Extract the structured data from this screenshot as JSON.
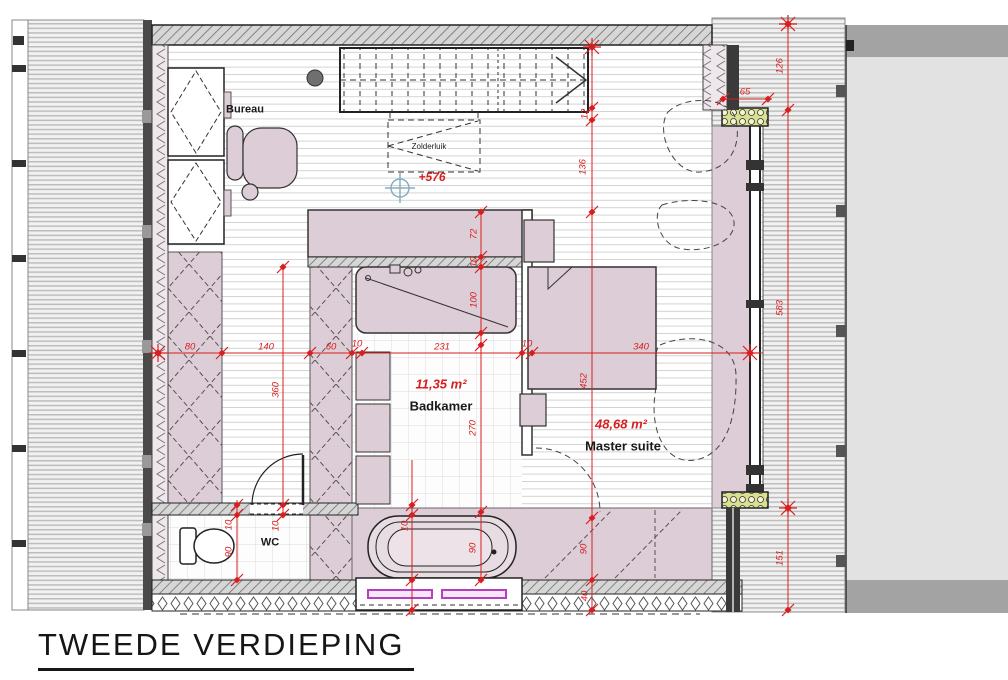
{
  "title": "TWEEDE VERDIEPING",
  "rooms": {
    "bureau": {
      "label": "Bureau"
    },
    "badkamer": {
      "label": "Badkamer",
      "area": "11,35 m²"
    },
    "master_suite": {
      "label": "Master suite",
      "area": "48,68 m²"
    },
    "wc": {
      "label": "WC"
    },
    "zolderluik": {
      "label": "Zolderluik"
    }
  },
  "level_marker": {
    "label": "+576"
  },
  "dims": {
    "chain": [
      "80",
      "140",
      "60",
      "10",
      "231",
      "10",
      "340"
    ],
    "storage_depth": "360",
    "wc_wall": "10",
    "wc_width": "90",
    "hall_wall": "10",
    "door_wall": "10",
    "shower_wall": "72",
    "shower_gap": "10",
    "shower_width": "100",
    "badkamer_depth": "270",
    "bath_width": "90",
    "stair_edge": "12",
    "stair_offset": "136",
    "bed_zone": "452",
    "ms_bottom": "90",
    "ms_wall": "40",
    "right_top": "126",
    "right_mid": "583",
    "right_bottom": "151",
    "window_offset": "65"
  },
  "colors": {
    "dimension_red": "#d81f1f",
    "wall_fill_pink": "#ddcdd6",
    "radiator_magenta": "#b63fc0",
    "level_marker_blue": "#86aec0",
    "roof_gray": "#f1f1f1",
    "adjacent_gray": "#e2e2e2"
  }
}
